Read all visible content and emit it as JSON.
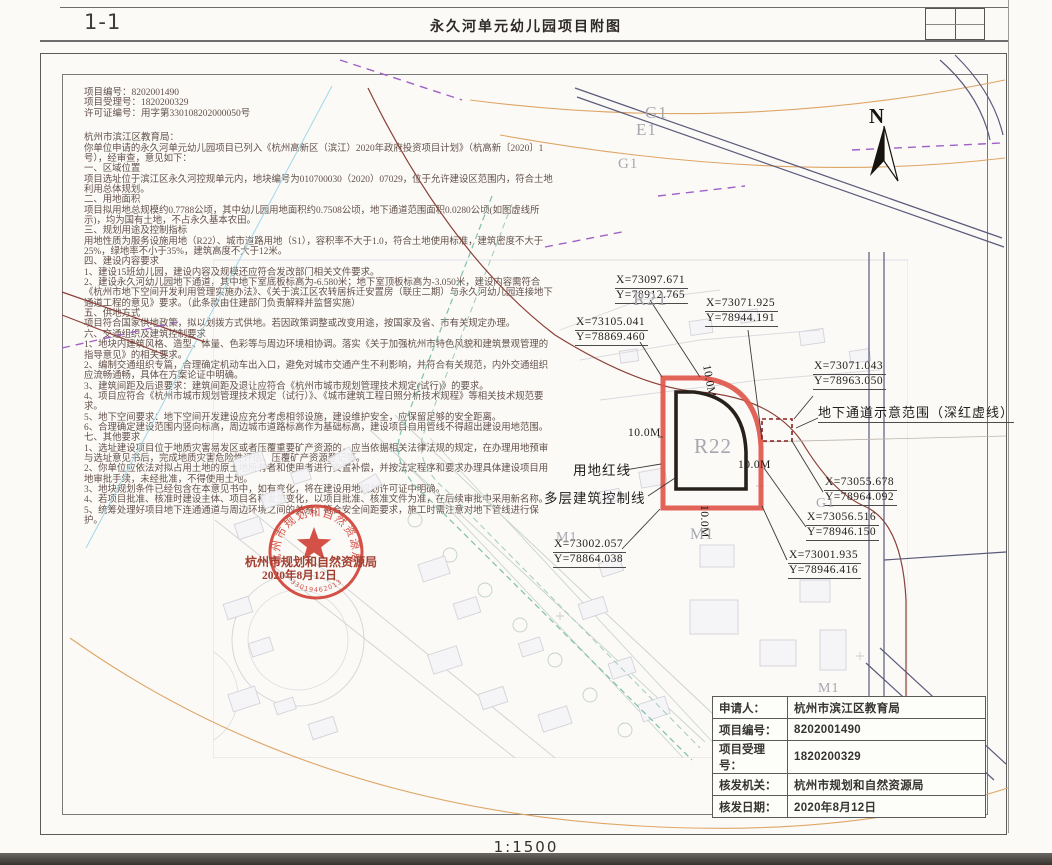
{
  "sheet": {
    "figure_no": "1-1",
    "title": "永久河单元幼儿园项目附图",
    "scale": "1:1500",
    "north_label": "N"
  },
  "notice": {
    "project_no_line": "项目编号：8202001490",
    "acceptance_no_line": "项目受理号：1820200329",
    "permit_no_line": "许可证编号：用字第330108202000050号",
    "recipient": "杭州市滨江区教育局：",
    "body": "你单位申请的永久河单元幼儿园项目已列入《杭州高新区（滨江）2020年政府投资项目计划》（杭高新〔2020〕1号），经审查，意见如下：\n一、区域位置\n项目选址位于滨江区永久河控规单元内，地块编号为010700030（2020）07029，位于允许建设区范围内，符合土地利用总体规划。\n二、用地面积\n项目拟用地总规模约0.7788公顷，其中幼儿园用地面积约0.7508公顷，地下通道范围面积0.0280公顷(如图虚线所示)，均为国有土地，不占永久基本农田。\n三、规划用途及控制指标\n用地性质为服务设施用地（R22）、城市道路用地（S1），容积率不大于1.0，符合土地使用标准，建筑密度不大于25%，绿地率不小于35%，建筑高度不大于12米。\n四、建设内容要求\n1、建设15班幼儿园，建设内容及规模还应符合发改部门相关文件要求。\n2、建设永久河幼儿园地下通道，其中地下室底板标高为-6.580米；地下室顶板标高为-3.050米，建设内容需符合《杭州市地下空间开发利用管理实施办法》、《关于滨江区农转居拆迁安置房（联庄二期）与永久河幼儿园连接地下通道工程的意见》要求。（此条款由住建部门负责解释并监督实施）\n五、供地方式\n项目符合国家供地政策，拟以划拨方式供地。若因政策调整或改变用途，按国家及省、市有关规定办理。\n六、交通组织及建筑控制要求\n1、地块内建筑风格、造型、体量、色彩等与周边环境相协调。落实《关于加强杭州市特色风貌和建筑景观管理的指导意见》的相关要求。\n2、编制交通组织专篇，合理确定机动车出入口，避免对城市交通产生不利影响，并符合有关规范，内外交通组织应流畅通畅，具体在方案论证中明确。\n3、建筑间距及后退要求：建筑间距及退让应符合《杭州市城市规划管理技术规定(试行)》的要求。\n4、项目应符合《杭州市城市规划管理技术规定（试行）》、《城市建筑工程日照分析技术规程》等相关技术规范要求。\n5、地下空间要求：地下空间开发建设应充分考虑相邻设施，建设维护安全，应保留足够的安全距离。\n6、合理确定建设范围内竖向标高，周边城市道路标高作为基础标高，建设项目自用管线不得超出建设用地范围。\n七、其他要求\n1、选址建设项目位于地质灾害易发区或者压覆重要矿产资源的，应当依据相关法律法规的规定，在办理用地预审与选址意见书后，完成地质灾害危险性评估、压覆矿产资源登记等。\n2、你单位应依法对拟占用土地的原土地所有者和使用者进行安置补偿，并按法定程序和要求办理具体建设项目用地审批手续，未经批准，不得使用土地。\n3、地块规划条件已经包含在本意见书中，如有变化，将在建设用地规划许可证中明确。\n4、若项目批准、核准时建设主体、项目名称发生变化，以项目批准、核准文件为准，在后续审批中采用新名称。\n5、统筹处理好项目地下连通通道与周边环境之间的关系，符合安全间距要求，施工时需注意对地下管线进行保护。"
  },
  "map": {
    "coords": [
      {
        "x": "X=73097.671",
        "y": "Y=78912.765"
      },
      {
        "x": "X=73071.925",
        "y": "Y=78944.191"
      },
      {
        "x": "X=73105.041",
        "y": "Y=78869.460"
      },
      {
        "x": "X=73071.043",
        "y": "Y=78963.050"
      },
      {
        "x": "X=73055.678",
        "y": "Y=78964.092"
      },
      {
        "x": "X=73056.516",
        "y": "Y=78946.150"
      },
      {
        "x": "X=73001.935",
        "y": "Y=78946.416"
      },
      {
        "x": "X=73002.057",
        "y": "Y=78864.038"
      }
    ],
    "dim_label": "10.0M",
    "red_line_label": "用地红线",
    "control_line_label": "多层建筑控制线",
    "tunnel_label": "地下通道示意范围（深红虚线）",
    "zones": {
      "r21": "R21",
      "r22": "R22",
      "m1": "M1",
      "g1": "G1",
      "e1": "E1"
    },
    "stamp": {
      "org": "杭州市规划和自然资源局",
      "date": "2020年8月12日",
      "serial": "33019462013773"
    }
  },
  "info_table": {
    "rows": [
      {
        "label": "申请人：",
        "value": "杭州市滨江区教育局"
      },
      {
        "label": "项目编号：",
        "value": "8202001490"
      },
      {
        "label": "项目受理号：",
        "value": "1820200329"
      },
      {
        "label": "核发机关：",
        "value": "杭州市规划和自然资源局"
      },
      {
        "label": "核发日期：",
        "value": "2020年8月12日"
      }
    ]
  },
  "colors": {
    "parcel_red": "#e0564a",
    "control_black": "#28211b",
    "tunnel_dark_red": "#8a1f1f",
    "stamp_red": "#cf3a30",
    "road_navy": "#5a5a7c",
    "curve_orange": "#dfa567",
    "dash_purple": "#a060c8",
    "channel_teal": "#7fbfae"
  }
}
